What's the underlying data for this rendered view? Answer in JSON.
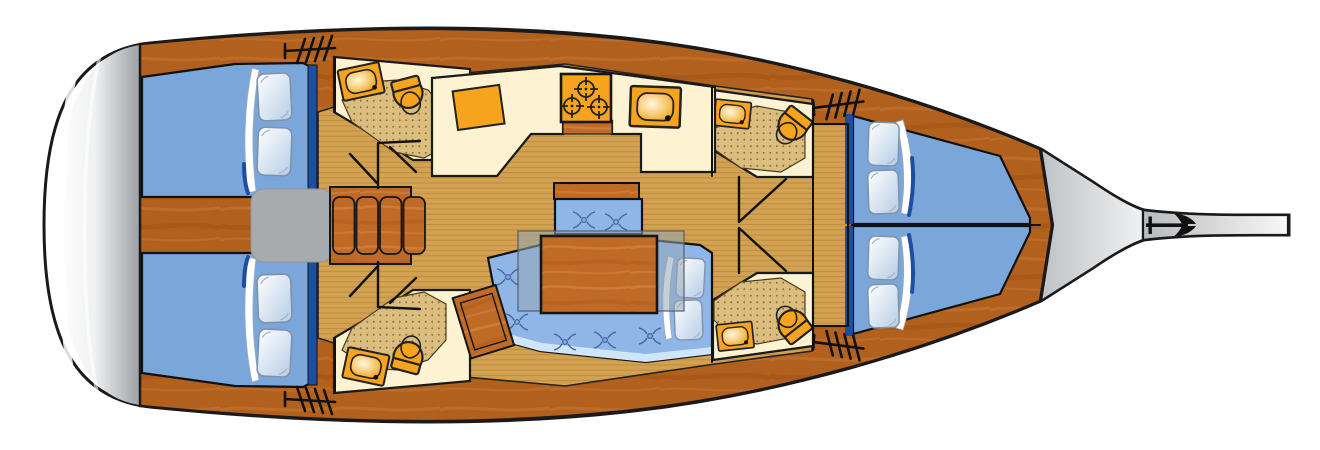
{
  "diagram": {
    "title": "Sailing yacht interior deck plan, bow facing right",
    "type": "boat-floor-plan",
    "palette": {
      "outline": "#1a1a1a",
      "deck_wood": "#b2601e",
      "deck_streak_light": "#cb7c36",
      "deck_streak_dark": "#94480f",
      "furniture_wood": "#c06a28",
      "furniture_streak_light": "#d98e47",
      "furniture_streak_dark": "#9c5212",
      "cabin_sole": "#d2a252",
      "cabin_sole_stripe": "#bd8c3e",
      "shower_floor": "#dcbd80",
      "shower_dot": "#8f7037",
      "head_cream": "#fdf3d2",
      "fixture_orange": "#f6a41d",
      "bed_blue": "#7ba6da",
      "settee_blue": "#8fb6e6",
      "bed_trim_navy": "#1d4fa0",
      "settee_edge_light": "#cfe6f8",
      "companionway_gray": "#a8abad",
      "platform_gray": "#9da0a4",
      "table_leaf": "rgba(150,168,182,0.55)",
      "logo_black": "#111111"
    },
    "areas": {
      "stern_platform": "swim platform",
      "aft_cabin_port": "aft double berth with two pillows and folded blanket",
      "aft_cabin_starboard": "aft double berth with two pillows and folded blanket",
      "aft_head_port": "head with sink, toilet and shower floor",
      "aft_head_starboard": "head with sink, toilet and shower floor",
      "forward_head_port": "head with sink, toilet and shower floor",
      "forward_head_starboard": "head with sink, toilet and shower floor",
      "galley": "galley with three-burner stove, sink and worktop",
      "salon": "salon with folding table, U-shaped settee, bench seat and cushions",
      "companionway": "companionway with landing pad and four wooden steps",
      "forward_berth_port": "forward berth with two pillows",
      "forward_berth_starboard": "forward berth with two pillows",
      "bow": "foredeck and bowsprit with builder trident logo"
    },
    "icons": [
      "toilet-icon",
      "sink-icon",
      "stove-burner-icon",
      "steps-icon",
      "tuft-icon",
      "pillow-icon",
      "trident-logo-icon"
    ]
  }
}
